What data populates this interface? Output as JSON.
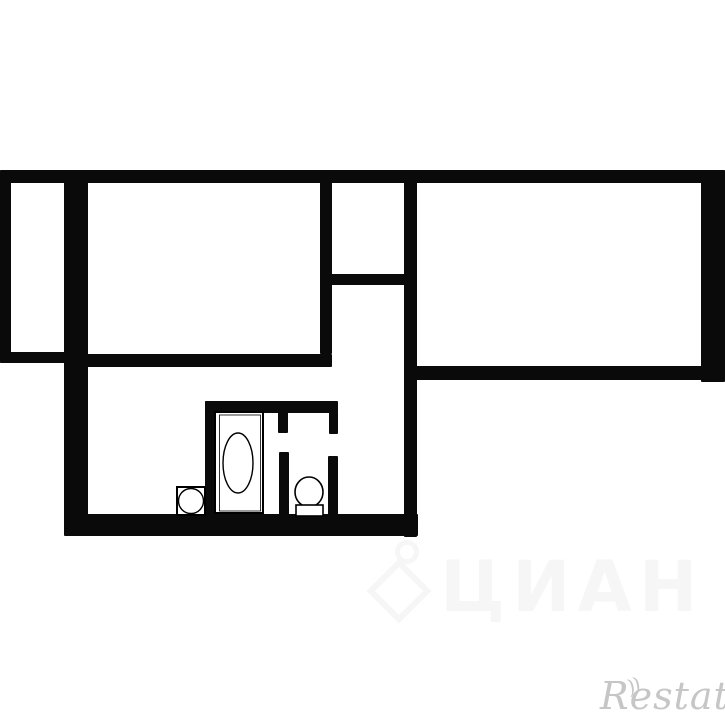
{
  "canvas": {
    "width": 725,
    "height": 725,
    "background_color": "#ffffff",
    "wall_color": "#0a0a0a",
    "fixture_stroke_color": "#000000",
    "watermark_restate_color": "#c6c6c6",
    "watermark_cian_color": "#f6f6f6"
  },
  "watermarks": {
    "bottom_right_text": "Restate",
    "bottom_right_mark": "))",
    "bottom_center_text": "ЦИАН"
  },
  "floorplan": {
    "description": "black-and-white apartment floor plan, thick walls, bathroom with bathtub, sink and toilet",
    "walls": [
      {
        "name": "top-wall",
        "x": 0,
        "y": 170,
        "w": 725,
        "h": 13
      },
      {
        "name": "left-wall",
        "x": 0,
        "y": 170,
        "w": 11,
        "h": 193
      },
      {
        "name": "balcony-bottom-wall",
        "x": 0,
        "y": 352,
        "w": 66,
        "h": 11
      },
      {
        "name": "left-thick-wall",
        "x": 64,
        "y": 170,
        "w": 24,
        "h": 365
      },
      {
        "name": "room-divider-wall",
        "x": 320,
        "y": 170,
        "w": 12,
        "h": 184
      },
      {
        "name": "small-room-bottom-wall",
        "x": 320,
        "y": 274,
        "w": 97,
        "h": 11
      },
      {
        "name": "center-vertical-wall",
        "x": 404,
        "y": 170,
        "w": 13,
        "h": 367
      },
      {
        "name": "left-room-bottom-wall",
        "x": 82,
        "y": 354,
        "w": 250,
        "h": 13
      },
      {
        "name": "right-room-bottom-wall",
        "x": 404,
        "y": 366,
        "w": 321,
        "h": 14
      },
      {
        "name": "right-wall",
        "x": 701,
        "y": 170,
        "w": 24,
        "h": 212
      },
      {
        "name": "bottom-wall",
        "x": 64,
        "y": 514,
        "w": 354,
        "h": 22
      },
      {
        "name": "bathroom-left-wall",
        "x": 205,
        "y": 401,
        "w": 11,
        "h": 115
      },
      {
        "name": "bathroom-top-wall",
        "x": 205,
        "y": 401,
        "w": 133,
        "h": 12
      },
      {
        "name": "wc-left-wall-upper",
        "x": 278,
        "y": 412,
        "w": 10,
        "h": 21
      },
      {
        "name": "wc-left-wall-lower",
        "x": 279,
        "y": 452,
        "w": 10,
        "h": 63
      },
      {
        "name": "wc-right-wall-upper",
        "x": 329,
        "y": 412,
        "w": 9,
        "h": 22
      },
      {
        "name": "wc-right-wall-lower",
        "x": 328,
        "y": 456,
        "w": 10,
        "h": 59
      }
    ],
    "fixtures": [
      {
        "name": "bathtub",
        "shape": "rect",
        "x": 215,
        "y": 412,
        "w": 48,
        "h": 101,
        "sw": 2
      },
      {
        "name": "bathtub-inner-line",
        "shape": "rect",
        "x": 219.5,
        "y": 415,
        "w": 41,
        "h": 96,
        "sw": 0.8
      },
      {
        "name": "bathtub-basin",
        "shape": "ellipse",
        "cx": 238,
        "cy": 463,
        "rx": 15,
        "ry": 30,
        "sw": 1.4
      },
      {
        "name": "sink",
        "shape": "rect",
        "x": 177,
        "y": 487,
        "w": 28,
        "h": 28,
        "sw": 2
      },
      {
        "name": "sink-bowl",
        "shape": "circle",
        "cx": 191,
        "cy": 501,
        "r": 12.5,
        "sw": 1.4
      },
      {
        "name": "toilet-bowl",
        "shape": "ellipse",
        "cx": 309,
        "cy": 492,
        "rx": 14,
        "ry": 15,
        "sw": 1.6
      },
      {
        "name": "toilet-tank",
        "shape": "rect",
        "x": 296,
        "y": 505,
        "w": 27,
        "h": 11,
        "sw": 1.6
      }
    ]
  }
}
